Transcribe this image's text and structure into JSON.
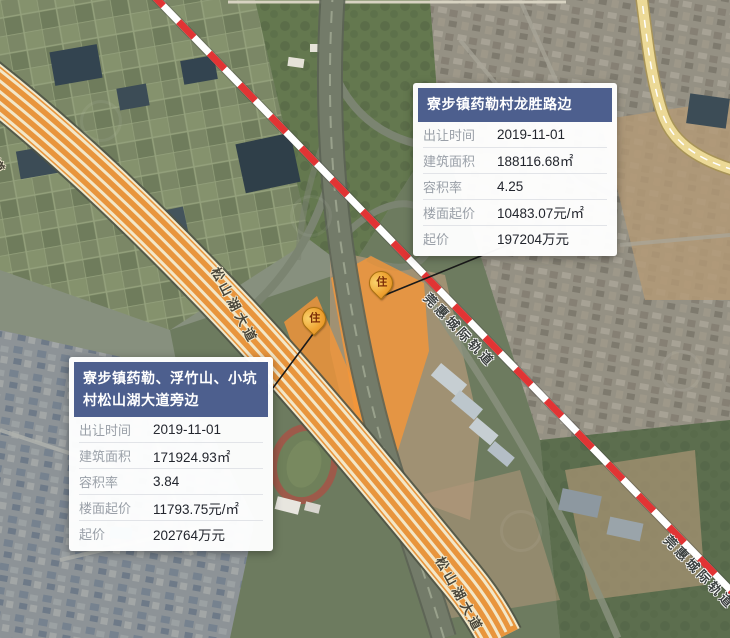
{
  "map": {
    "pins": [
      {
        "label": "住",
        "type": "residential-parcel-pin"
      },
      {
        "label": "住",
        "type": "residential-parcel-pin"
      }
    ],
    "road_labels": [
      "松山湖大道",
      "松山湖大道",
      "松山湖大道"
    ],
    "rail_labels": [
      "莞惠城际轨道",
      "莞惠城际轨道"
    ],
    "colors": {
      "parcel": "#f59638",
      "rail_dash": "#e13434",
      "highway": "#e8953d",
      "card_header": "#4d5f8e"
    }
  },
  "cards": [
    {
      "title": "寮步镇药勒村龙胜路边",
      "rows": [
        {
          "label": "出让时间",
          "value": "2019-11-01"
        },
        {
          "label": "建筑面积",
          "value": "188116.68㎡"
        },
        {
          "label": "容积率",
          "value": "4.25"
        },
        {
          "label": "楼面起价",
          "value": "10483.07元/㎡"
        },
        {
          "label": "起价",
          "value": "197204万元"
        }
      ]
    },
    {
      "title": "寮步镇药勒、浮竹山、小坑村松山湖大道旁边",
      "rows": [
        {
          "label": "出让时间",
          "value": "2019-11-01"
        },
        {
          "label": "建筑面积",
          "value": "171924.93㎡"
        },
        {
          "label": "容积率",
          "value": "3.84"
        },
        {
          "label": "楼面起价",
          "value": "11793.75元/㎡"
        },
        {
          "label": "起价",
          "value": "202764万元"
        }
      ]
    }
  ]
}
